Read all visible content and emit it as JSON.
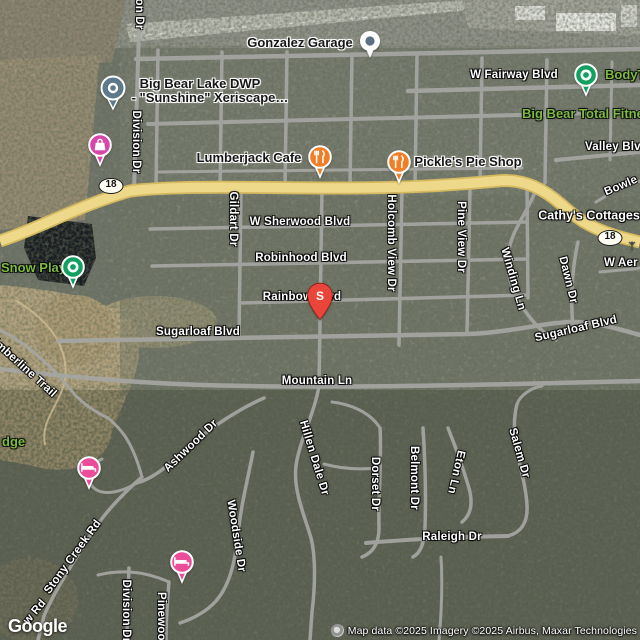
{
  "map": {
    "colors": {
      "highway_fill": "#eed98b",
      "highway_casing": "#d4b95f",
      "road_gray": "#a6a6a3",
      "restaurant_pin": "#f07e26",
      "green_pin": "#12a060",
      "hotel_pin": "#ec4d9b",
      "shopping_pin": "#d946ab",
      "generic_pin": "#5e7a8a",
      "dot_pin_center": "#5b7083",
      "red_pin": "#e9453b",
      "green_label": "#7dbb42"
    },
    "route_shields": [
      {
        "name": "route-18-shield-west",
        "label": "18",
        "x": 111,
        "y": 186
      },
      {
        "name": "route-18-shield-east",
        "label": "18",
        "x": 610,
        "y": 238
      }
    ],
    "labels": [
      {
        "name": "road-label-division-dr-top",
        "text": "on Dr",
        "x": 139,
        "y": 14,
        "rot": 90,
        "cls": "road",
        "clickable": false
      },
      {
        "name": "poi-label-gonzalez-garage",
        "text": "Gonzalez Garage",
        "x": 300,
        "y": 43,
        "rot": 0,
        "cls": "poi",
        "clickable": true
      },
      {
        "name": "road-label-w-fairway-blvd",
        "text": "W Fairway Blvd",
        "x": 514,
        "y": 75,
        "rot": 0,
        "cls": "road",
        "clickable": false
      },
      {
        "name": "poi-label-bodyt",
        "text": "BodyT",
        "x": 605,
        "y": 75,
        "rot": 0,
        "cls": "green",
        "align": "left",
        "clickable": true
      },
      {
        "name": "poi-label-big-bear-lake-dwp-line1",
        "text": "Big Bear Lake DWP",
        "x": 200,
        "y": 84,
        "rot": 0,
        "cls": "poi",
        "clickable": true
      },
      {
        "name": "poi-label-big-bear-lake-dwp-line2",
        "text": "- \"Sunshine\" Xeriscape…",
        "x": 210,
        "y": 98,
        "rot": 0,
        "cls": "poi",
        "clickable": true
      },
      {
        "name": "poi-label-big-bear-total-fitness",
        "text": "Big Bear Total Fitne",
        "x": 522,
        "y": 114,
        "rot": 0,
        "cls": "green",
        "align": "left",
        "clickable": true
      },
      {
        "name": "road-label-division-dr",
        "text": "Division Dr",
        "x": 136,
        "y": 142,
        "rot": 90,
        "cls": "road",
        "clickable": false
      },
      {
        "name": "road-label-valley-blvd",
        "text": "Valley Blvd",
        "x": 585,
        "y": 147,
        "rot": 0,
        "cls": "road",
        "align": "left",
        "clickable": false
      },
      {
        "name": "poi-label-lumberjack-cafe",
        "text": "Lumberjack Cafe",
        "x": 249,
        "y": 158,
        "rot": 0,
        "cls": "poi",
        "clickable": true
      },
      {
        "name": "poi-label-pickles-pie-shop",
        "text": "Pickle's Pie Shop",
        "x": 468,
        "y": 162,
        "rot": 0,
        "cls": "poi",
        "clickable": true
      },
      {
        "name": "road-label-bowle",
        "text": "Bowle",
        "x": 621,
        "y": 186,
        "rot": -23,
        "cls": "road",
        "clickable": false
      },
      {
        "name": "poi-label-cathys-cottages",
        "text": "Cathy's Cottages",
        "x": 589,
        "y": 216,
        "rot": 0,
        "cls": "white-poi",
        "clickable": true
      },
      {
        "name": "road-label-w-sherwood-blvd",
        "text": "W Sherwood Blvd",
        "x": 300,
        "y": 222,
        "rot": 0,
        "cls": "road",
        "clickable": false
      },
      {
        "name": "road-label-gildart-dr",
        "text": "Gildart Dr",
        "x": 233,
        "y": 219,
        "rot": 90,
        "cls": "road",
        "clickable": false
      },
      {
        "name": "road-label-holcomb-view-dr",
        "text": "Holcomb View Dr",
        "x": 391,
        "y": 243,
        "rot": 90,
        "cls": "road",
        "clickable": false
      },
      {
        "name": "road-label-pine-view-dr",
        "text": "Pine View Dr",
        "x": 461,
        "y": 237,
        "rot": 90,
        "cls": "road",
        "clickable": false
      },
      {
        "name": "road-label-robinhood-blvd",
        "text": "Robinhood Blvd",
        "x": 301,
        "y": 258,
        "rot": 0,
        "cls": "road",
        "clickable": false
      },
      {
        "name": "poi-label-snow-play",
        "text": "Snow Play",
        "x": 1,
        "y": 268,
        "rot": 0,
        "cls": "green",
        "align": "left",
        "clickable": true
      },
      {
        "name": "road-label-w-aeroplane",
        "text": "W Aer",
        "x": 604,
        "y": 263,
        "rot": 0,
        "cls": "road",
        "align": "left",
        "clickable": false
      },
      {
        "name": "road-label-winding-ln",
        "text": "Winding Ln",
        "x": 513,
        "y": 279,
        "rot": 74,
        "cls": "road",
        "clickable": false
      },
      {
        "name": "road-label-dawn-dr",
        "text": "Dawn Dr",
        "x": 568,
        "y": 280,
        "rot": 76,
        "cls": "road",
        "clickable": false
      },
      {
        "name": "road-label-rainbow-blvd",
        "text": "Rainbow Blvd",
        "x": 302,
        "y": 297,
        "rot": 0,
        "cls": "road",
        "clickable": false
      },
      {
        "name": "road-label-sugarloaf-blvd-east",
        "text": "Sugarloaf Blvd",
        "x": 576,
        "y": 329,
        "rot": -13,
        "cls": "road",
        "clickable": false
      },
      {
        "name": "road-label-sugarloaf-blvd-west",
        "text": "Sugarloaf Blvd",
        "x": 198,
        "y": 332,
        "rot": 0,
        "cls": "road",
        "clickable": false
      },
      {
        "name": "road-label-timberline-trail",
        "text": "Timberline Trail",
        "x": 22,
        "y": 366,
        "rot": 42,
        "cls": "road",
        "clickable": false
      },
      {
        "name": "road-label-mountain-ln",
        "text": "Mountain Ln",
        "x": 317,
        "y": 381,
        "rot": 0,
        "cls": "road",
        "clickable": false
      },
      {
        "name": "poi-label-lodge",
        "text": "dge",
        "x": 2,
        "y": 442,
        "rot": 0,
        "cls": "green",
        "align": "left",
        "clickable": true
      },
      {
        "name": "road-label-ashwood-dr",
        "text": "Ashwood Dr",
        "x": 191,
        "y": 446,
        "rot": -44,
        "cls": "road",
        "clickable": false
      },
      {
        "name": "road-label-hillen-dale-dr",
        "text": "Hillen Dale Dr",
        "x": 314,
        "y": 458,
        "rot": 73,
        "cls": "road",
        "clickable": false
      },
      {
        "name": "road-label-eton-ln",
        "text": "Eton Ln",
        "x": 456,
        "y": 472,
        "rot": 103,
        "cls": "road",
        "clickable": false
      },
      {
        "name": "road-label-salem-dr",
        "text": "Salem Dr",
        "x": 519,
        "y": 453,
        "rot": 74,
        "cls": "road",
        "clickable": false
      },
      {
        "name": "road-label-dorset-dr",
        "text": "Dorset Dr",
        "x": 375,
        "y": 484,
        "rot": 90,
        "cls": "road",
        "clickable": false
      },
      {
        "name": "road-label-belmont-dr",
        "text": "Belmont Dr",
        "x": 414,
        "y": 478,
        "rot": 90,
        "cls": "road",
        "clickable": false
      },
      {
        "name": "road-label-woodside-dr",
        "text": "Woodside Dr",
        "x": 236,
        "y": 536,
        "rot": 81,
        "cls": "road",
        "clickable": false
      },
      {
        "name": "road-label-raleigh-dr",
        "text": "Raleigh Dr",
        "x": 452,
        "y": 537,
        "rot": 0,
        "cls": "road",
        "clickable": false
      },
      {
        "name": "road-label-stony-creek-rd",
        "text": "Stony Creek Rd",
        "x": 73,
        "y": 557,
        "rot": -54,
        "cls": "road",
        "clickable": false
      },
      {
        "name": "road-label-w-rd-fragment",
        "text": "w Rd",
        "x": 35,
        "y": 612,
        "rot": -50,
        "cls": "road",
        "clickable": false
      },
      {
        "name": "road-label-division-dr-south",
        "text": "Division Dr",
        "x": 126,
        "y": 611,
        "rot": 90,
        "cls": "road",
        "clickable": false
      },
      {
        "name": "road-label-pinewood",
        "text": "Pinewood",
        "x": 161,
        "y": 620,
        "rot": 90,
        "cls": "road",
        "clickable": false
      }
    ],
    "markers": [
      {
        "name": "gonzalez-garage-marker",
        "type": "dot",
        "x": 370,
        "y": 41
      },
      {
        "name": "big-bear-lake-dwp-marker",
        "type": "generic",
        "x": 113,
        "y": 88
      },
      {
        "name": "shopping-poi-pin",
        "type": "shopping",
        "x": 100,
        "y": 145
      },
      {
        "name": "bodyt-poi-pin",
        "type": "green",
        "x": 586,
        "y": 75
      },
      {
        "name": "snow-play-poi-pin",
        "type": "green",
        "x": 73,
        "y": 267
      },
      {
        "name": "lumberjack-cafe-pin",
        "type": "restaurant",
        "x": 320,
        "y": 157
      },
      {
        "name": "pickles-pie-shop-pin",
        "type": "restaurant",
        "x": 399,
        "y": 162
      },
      {
        "name": "search-result-pin",
        "type": "redletter",
        "x": 320,
        "y": 296,
        "letter": "S"
      },
      {
        "name": "hotel-pin-west",
        "type": "hotel",
        "x": 89,
        "y": 468
      },
      {
        "name": "hotel-pin-south",
        "type": "hotel",
        "x": 182,
        "y": 562
      },
      {
        "name": "antenna-poi-icon",
        "type": "tiny",
        "x": 632,
        "y": 246
      }
    ],
    "footer": {
      "logo": "Google",
      "attribution": "Map data ©2025 Imagery ©2025 Airbus, Maxar Technologies"
    }
  }
}
